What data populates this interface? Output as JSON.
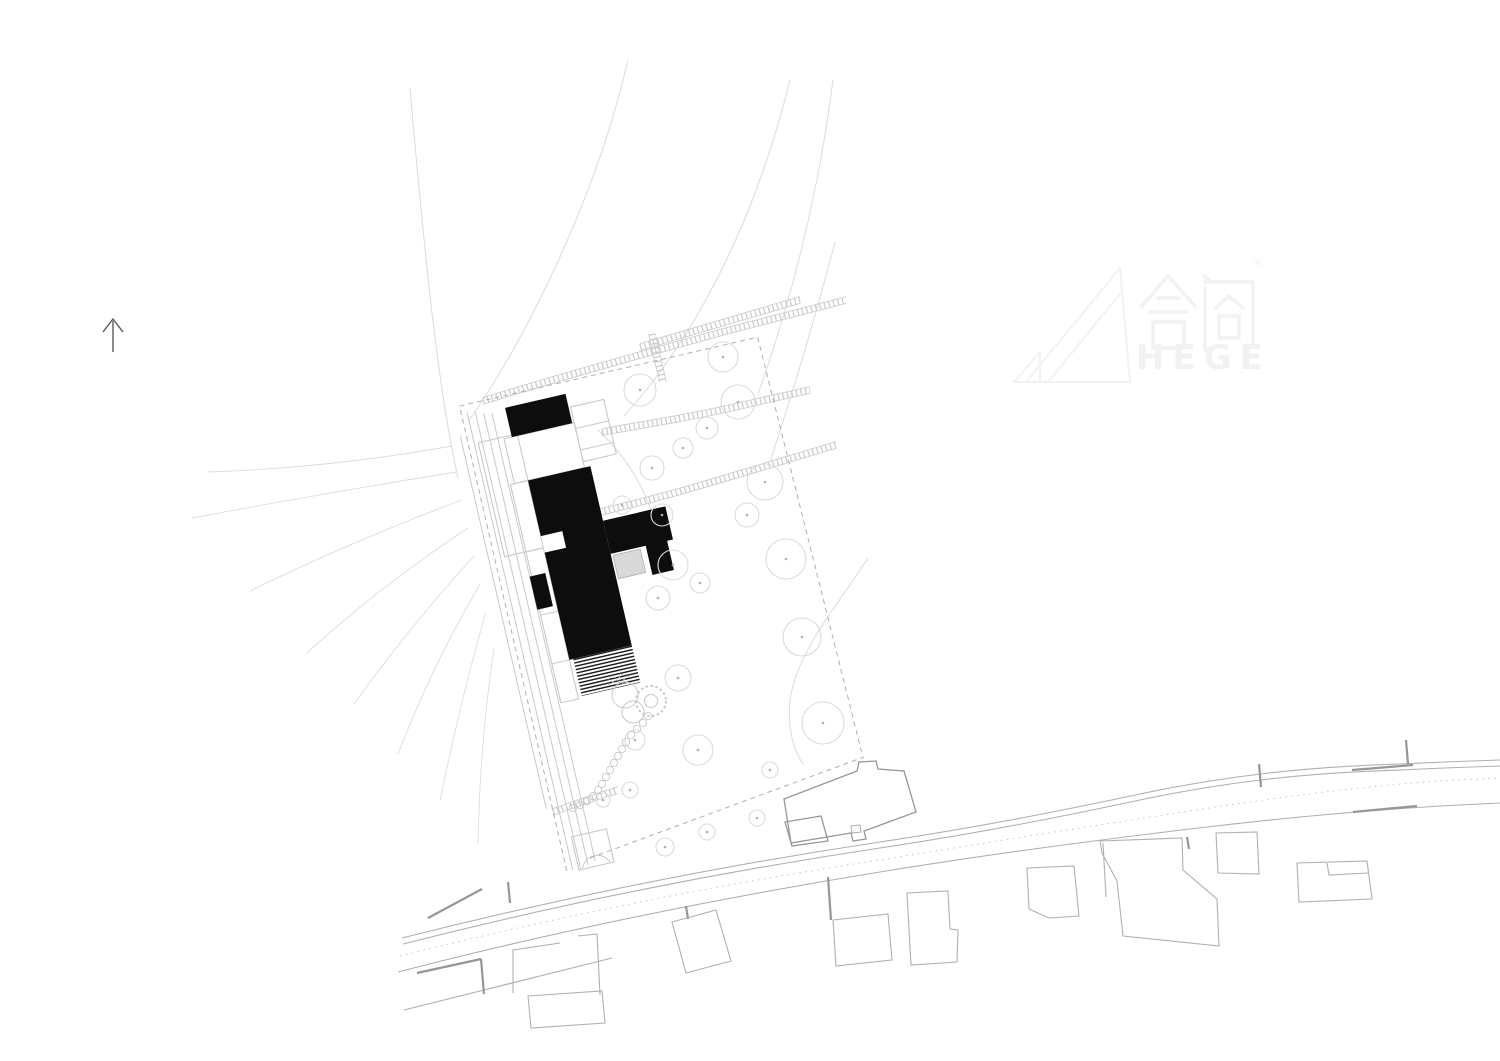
{
  "watermark": {
    "cjk": "合阁",
    "registered": "®",
    "latin": "HEGE"
  },
  "palette": {
    "background": "#ffffff",
    "line_faint": "#dcdcdc",
    "line_light": "#c9c9c9",
    "line_medium": "#b0b0b0",
    "line_dark": "#979797",
    "building_fill": "#0d0d0d",
    "gray_block_fill": "#d9d9d9",
    "watermark_color": "#f2f2f2",
    "north_arrow_color": "#5a5a5a"
  },
  "plan": {
    "rotation_deg": -13,
    "pivot": [
      540,
      408
    ],
    "contours": [
      "M410,88 C424,250 438,390 458,478",
      "M628,60 C598,190 532,330 468,422",
      "M790,80 C758,210 702,330 624,416",
      "M833,80 C818,200 788,310 758,394",
      "M835,242 C812,330 787,410 770,462",
      "M868,558 C833,612 797,652 790,700 C787,732 795,752 803,764",
      "M598,430 C640,470 662,520 656,560"
    ],
    "fan_lines": [
      "M452,446 Q330,468 208,472",
      "M456,472 Q320,494 192,518",
      "M462,500 Q350,542 250,591",
      "M468,528 Q380,586 307,653",
      "M474,556 Q410,626 354,704",
      "M480,584 Q432,666 398,754",
      "M486,612 Q460,702 440,801",
      "M494,648 Q480,742 478,843"
    ],
    "ladders": [
      {
        "d": "M483,401 C560,377 650,352 730,330 C770,320 815,308 846,300",
        "edge": [
          0,
          3.4
        ]
      },
      {
        "d": "M652,334 C656,352 659,366 663,382",
        "edge": [
          3.4,
          0
        ]
      },
      {
        "d": "M640,347 C700,329 755,313 800,300",
        "edge": [
          0,
          3.4
        ]
      },
      {
        "d": "M602,432 C660,422 706,414 748,404 C770,399 792,394 810,390",
        "edge": [
          0,
          3.4
        ]
      },
      {
        "d": "M600,512 C670,496 752,470 836,445",
        "edge": [
          0,
          3.4
        ]
      },
      {
        "d": "M553,812 C575,804 596,797 618,790",
        "edge": [
          0,
          3.4
        ]
      }
    ],
    "site": {
      "dashed": [
        "M462,392 L462,868",
        "M462,388 L768,388",
        "M768,388 L776,818"
      ],
      "solid": [
        "M468,396 L468,866",
        "M476,398 L476,866",
        "M484,400 L484,864",
        "M492,402 L492,862",
        "M456,418 L456,800"
      ],
      "rects": [
        [
          472,
          428,
          40,
          117
        ],
        [
          494,
          476,
          18,
          224
        ],
        [
          498,
          430,
          72,
          46
        ],
        [
          570,
          414,
          34,
          56
        ],
        [
          474,
          833,
          36,
          34
        ]
      ],
      "seglines": [
        "M494,545 L512,545",
        "M494,610 L512,610",
        "M494,660 L512,660",
        "M570,436 L604,436",
        "M570,458 L604,458",
        "M478,866 A15,15 0 0 1 506,866"
      ],
      "black_blocks": [
        [
          506,
          400,
          62,
          30
        ],
        [
          512,
          476,
          64,
          184
        ],
        [
          576,
          532,
          64,
          34
        ],
        [
          612,
          532,
          22,
          64
        ],
        [
          492,
          570,
          16,
          34
        ]
      ],
      "white_cuts": [
        [
          512,
          533,
          22,
          17
        ]
      ],
      "gray_block": [
        578,
        568,
        28,
        24
      ],
      "hatch_rect": [
        516,
        660,
        60,
        38
      ]
    },
    "trees": [
      [
        640,
        390,
        16
      ],
      [
        723,
        357,
        15
      ],
      [
        738,
        402,
        17
      ],
      [
        707,
        428,
        11
      ],
      [
        683,
        448,
        10
      ],
      [
        652,
        468,
        12
      ],
      [
        622,
        505,
        9
      ],
      [
        662,
        515,
        11
      ],
      [
        765,
        482,
        18
      ],
      [
        747,
        515,
        12
      ],
      [
        673,
        565,
        15
      ],
      [
        700,
        583,
        10
      ],
      [
        658,
        598,
        12
      ],
      [
        786,
        559,
        20
      ],
      [
        802,
        637,
        19
      ],
      [
        823,
        723,
        21
      ],
      [
        678,
        678,
        13
      ],
      [
        698,
        750,
        15
      ],
      [
        635,
        740,
        10
      ],
      [
        630,
        790,
        8
      ],
      [
        603,
        800,
        7
      ],
      [
        665,
        847,
        9
      ],
      [
        707,
        832,
        8
      ],
      [
        757,
        818,
        8
      ],
      [
        770,
        770,
        8
      ]
    ],
    "spiral": {
      "circles": [
        [
          625,
          695,
          13
        ],
        [
          633,
          712,
          11
        ]
      ],
      "ring": [
        651,
        701,
        15,
        6.5
      ],
      "dotted_circles": [
        [
          613,
          682,
          5
        ],
        [
          624,
          679,
          5
        ]
      ]
    },
    "chain": [
      [
        648,
        716
      ],
      [
        643,
        723
      ],
      [
        637,
        729
      ],
      [
        631,
        735
      ],
      [
        626,
        742
      ],
      [
        622,
        749
      ],
      [
        618,
        756
      ],
      [
        614,
        763
      ],
      [
        610,
        770
      ],
      [
        606,
        777
      ],
      [
        602,
        784
      ],
      [
        598,
        790
      ],
      [
        593,
        796
      ],
      [
        587,
        801
      ],
      [
        580,
        805
      ],
      [
        573,
        808
      ]
    ],
    "chain_radius": 3.6,
    "boundary_bottom_dashed": "M590,858 L864,757",
    "roads": [
      {
        "d": "M402,938 C560,898 720,866 880,842 C980,827 1060,811 1140,794 C1220,777 1300,767 1400,764 C1440,762 1470,761 1500,760",
        "dotted": false
      },
      {
        "d": "M403,944 C560,904 720,872 880,848 C980,833 1060,817 1140,800 C1220,783 1300,773 1400,770 C1440,768 1470,767 1500,766",
        "dotted": false
      },
      {
        "d": "M400,956 C560,916 720,884 880,860 C990,842 1080,828 1170,814 C1260,800 1350,787 1440,781 L1500,778",
        "dotted": true
      },
      {
        "d": "M398,972 C560,930 720,898 880,872 C990,854 1090,841 1190,829 C1280,818 1380,809 1460,805 L1500,803",
        "dotted": false
      },
      {
        "d": "M404,1010 C470,994 540,976 612,958",
        "dotted": false
      }
    ],
    "walls": [
      [
        428,
        918,
        482,
        889
      ],
      [
        508,
        882,
        510,
        903
      ],
      [
        417,
        973,
        481,
        959
      ],
      [
        481,
        959,
        484,
        994
      ],
      [
        1352,
        770,
        1413,
        765
      ],
      [
        1353,
        812,
        1417,
        806
      ],
      [
        1406,
        740,
        1408,
        764
      ],
      [
        1259,
        764,
        1261,
        787
      ],
      [
        1187,
        837,
        1189,
        849
      ],
      [
        686,
        906,
        688,
        919
      ],
      [
        828,
        877,
        831,
        920
      ]
    ],
    "neighbors": [
      {
        "pts": [
          [
            528,
            996
          ],
          [
            602,
            991
          ],
          [
            605,
            1023
          ],
          [
            531,
            1028
          ]
        ],
        "closed": true,
        "dark": false
      },
      {
        "pts": [
          [
            513,
            993
          ],
          [
            513,
            950
          ],
          [
            560,
            943
          ]
        ],
        "closed": false,
        "dark": false
      },
      {
        "pts": [
          [
            578,
            936
          ],
          [
            597,
            934
          ],
          [
            600,
            995
          ]
        ],
        "closed": false,
        "dark": false
      },
      {
        "pts": [
          [
            672,
            922
          ],
          [
            716,
            910
          ],
          [
            731,
            961
          ],
          [
            686,
            973
          ]
        ],
        "closed": true,
        "dark": false
      },
      {
        "pts": [
          [
            833,
            920
          ],
          [
            888,
            914
          ],
          [
            892,
            960
          ],
          [
            836,
            966
          ]
        ],
        "closed": true,
        "dark": false
      },
      {
        "pts": [
          [
            907,
            893
          ],
          [
            948,
            891
          ],
          [
            950,
            929
          ],
          [
            958,
            930
          ],
          [
            957,
            962
          ],
          [
            911,
            965
          ]
        ],
        "closed": true,
        "dark": false
      },
      {
        "pts": [
          [
            1027,
            868
          ],
          [
            1074,
            866
          ],
          [
            1079,
            916
          ],
          [
            1049,
            918
          ],
          [
            1029,
            909
          ]
        ],
        "closed": true,
        "dark": false
      },
      {
        "pts": [
          [
            1100,
            841
          ],
          [
            1182,
            838
          ],
          [
            1183,
            870
          ],
          [
            1217,
            899
          ],
          [
            1219,
            946
          ],
          [
            1123,
            936
          ],
          [
            1117,
            881
          ],
          [
            1102,
            853
          ]
        ],
        "closed": true,
        "dark": false
      },
      {
        "pts": [
          [
            1103,
            843
          ],
          [
            1106,
            897
          ]
        ],
        "closed": false,
        "dark": false
      },
      {
        "pts": [
          [
            1216,
            833
          ],
          [
            1257,
            832
          ],
          [
            1259,
            874
          ],
          [
            1218,
            873
          ]
        ],
        "closed": true,
        "dark": false
      },
      {
        "pts": [
          [
            1297,
            863
          ],
          [
            1367,
            861
          ],
          [
            1372,
            899
          ],
          [
            1299,
            902
          ]
        ],
        "closed": true,
        "dark": false
      },
      {
        "pts": [
          [
            1327,
            863
          ],
          [
            1329,
            875
          ],
          [
            1368,
            873
          ]
        ],
        "closed": false,
        "dark": false
      },
      {
        "pts": [
          [
            851,
            826
          ],
          [
            860,
            825
          ],
          [
            861,
            832
          ],
          [
            852,
            833
          ]
        ],
        "closed": true,
        "dark": false
      },
      {
        "pts": [
          [
            784,
            799
          ],
          [
            857,
            771
          ],
          [
            859,
            762
          ],
          [
            876,
            761
          ],
          [
            878,
            769
          ],
          [
            904,
            771
          ],
          [
            916,
            812
          ],
          [
            864,
            831
          ],
          [
            866,
            839
          ],
          [
            853,
            841
          ],
          [
            851,
            833
          ],
          [
            791,
            843
          ]
        ],
        "closed": true,
        "dark": true
      },
      {
        "pts": [
          [
            785,
            822
          ],
          [
            821,
            816
          ],
          [
            828,
            841
          ],
          [
            792,
            846
          ]
        ],
        "closed": true,
        "dark": true
      }
    ]
  }
}
